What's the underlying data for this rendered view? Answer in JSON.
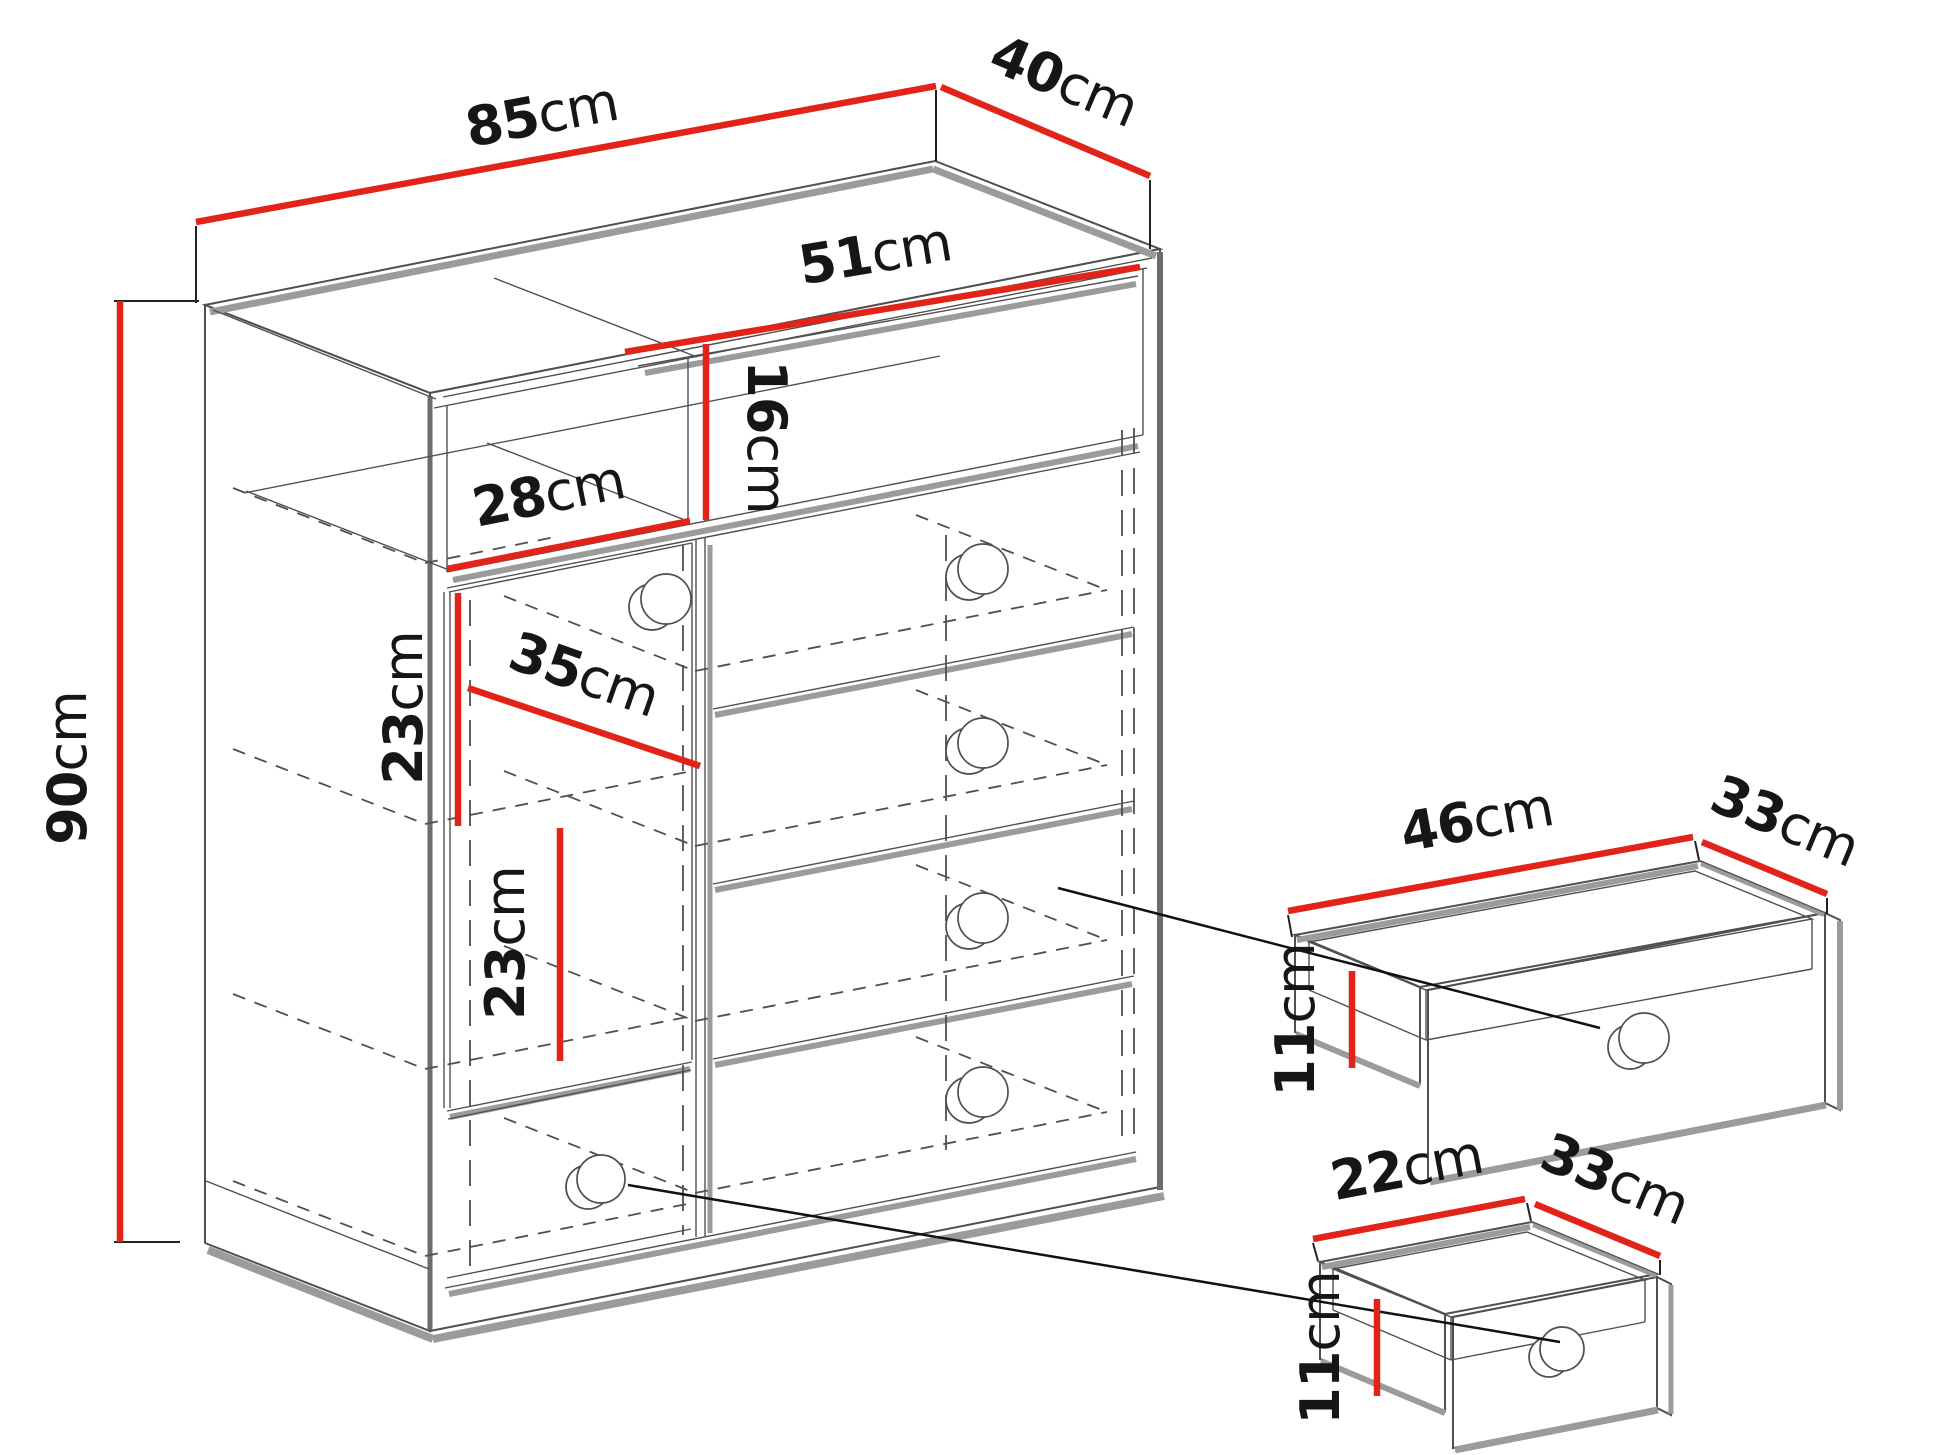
{
  "diagram": {
    "type": "furniture-dimension-drawing",
    "subject": "chest of drawers with open niche, door compartment and drawers, plus two extracted drawer boxes",
    "unit": "cm",
    "colors": {
      "dimension_red": "#e2231a",
      "line_gray": "#4f4f4f",
      "shadow_gray": "#9b9b9b",
      "text_black": "#161616",
      "background": "#ffffff"
    },
    "cabinet": {
      "width_cm": 85,
      "depth_cm": 40,
      "height_cm": 90,
      "niche_width_cm": 51,
      "niche_height_cm": 16,
      "left_compartment_width_cm": 28,
      "left_compartment_depth_cm": 35,
      "upper_shelf_gap_cm": 23,
      "lower_shelf_gap_cm": 23
    },
    "large_drawer": {
      "width_cm": 46,
      "depth_cm": 33,
      "height_cm": 11
    },
    "small_drawer": {
      "width_cm": 22,
      "depth_cm": 33,
      "height_cm": 11
    },
    "labels": {
      "cabinet_width": {
        "value": "85",
        "unit": "cm"
      },
      "cabinet_depth": {
        "value": "40",
        "unit": "cm"
      },
      "cabinet_height": {
        "value": "90",
        "unit": "cm"
      },
      "niche_width": {
        "value": "51",
        "unit": "cm"
      },
      "niche_height": {
        "value": "16",
        "unit": "cm"
      },
      "left_compartment_width": {
        "value": "28",
        "unit": "cm"
      },
      "left_compartment_depth": {
        "value": "35",
        "unit": "cm"
      },
      "upper_shelf_gap": {
        "value": "23",
        "unit": "cm"
      },
      "lower_shelf_gap": {
        "value": "23",
        "unit": "cm"
      },
      "large_drawer_width": {
        "value": "46",
        "unit": "cm"
      },
      "large_drawer_depth": {
        "value": "33",
        "unit": "cm"
      },
      "large_drawer_height": {
        "value": "11",
        "unit": "cm"
      },
      "small_drawer_width": {
        "value": "22",
        "unit": "cm"
      },
      "small_drawer_depth": {
        "value": "33",
        "unit": "cm"
      },
      "small_drawer_height": {
        "value": "11",
        "unit": "cm"
      }
    }
  }
}
